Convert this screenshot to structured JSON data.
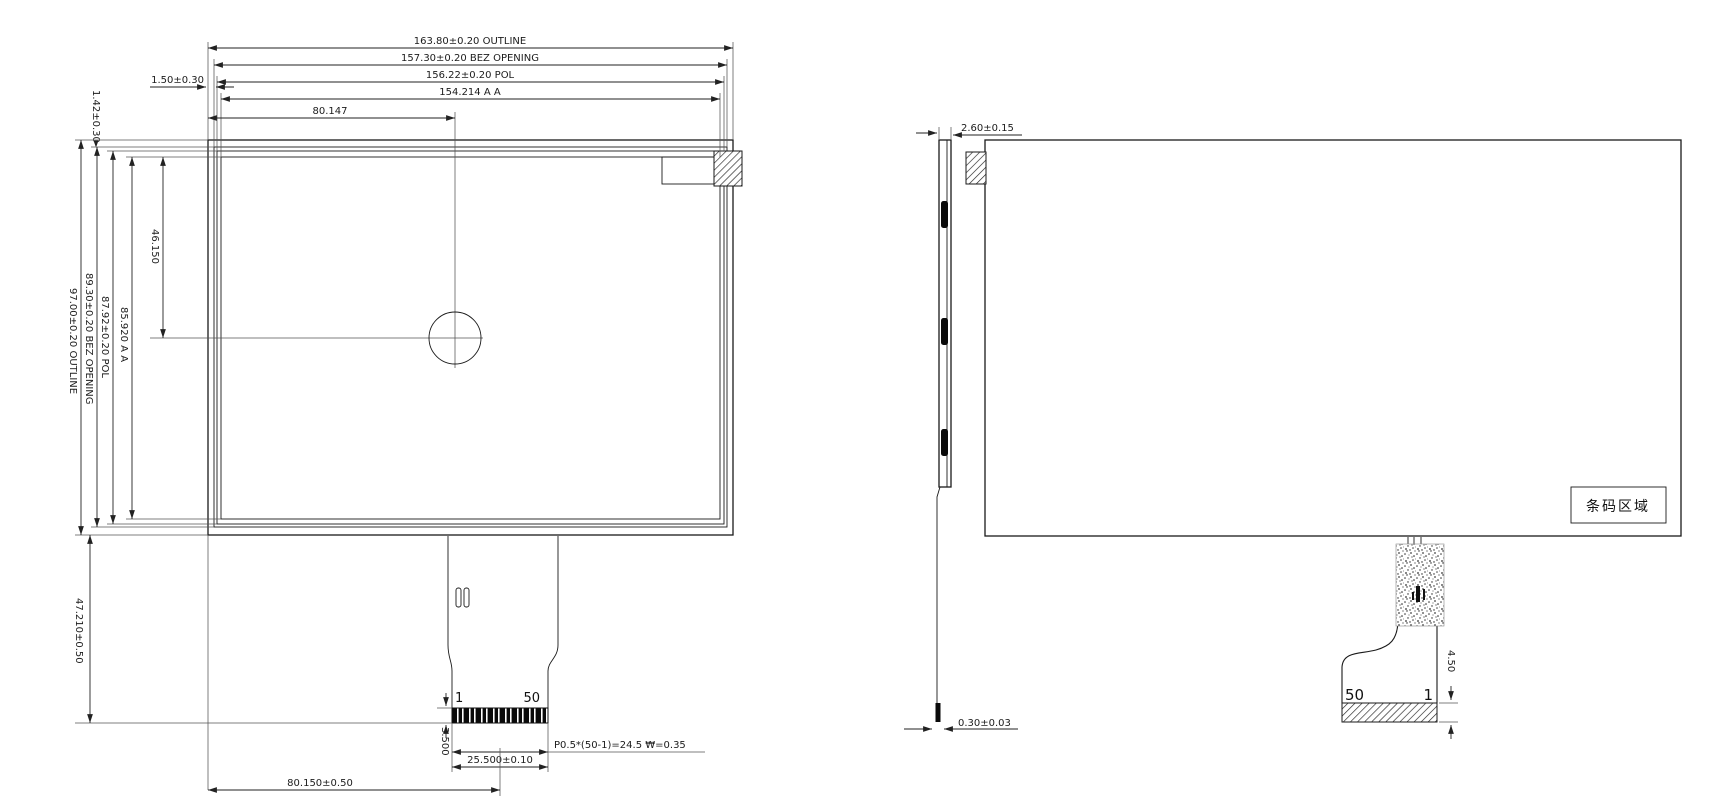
{
  "drawing_title": "LCD module outline drawing (front view, side view, rear view)",
  "front_view": {
    "dim_outline_width": "163.80±0.20 OUTLINE",
    "dim_bezel_width": "157.30±0.20 BEZ OPENING",
    "dim_pol_width": "156.22±0.20 POL",
    "dim_aa_width": "154.214 A A",
    "dim_center_x": "80.147",
    "dim_bezel_inset_left": "1.50±0.30",
    "dim_bezel_inset_top": "1.42±0.30",
    "dim_outline_height": "97.00±0.20 OUTLINE",
    "dim_bezel_height": "89.30±0.20 BEZ OPENING",
    "dim_pol_height": "87.92±0.20 POL",
    "dim_aa_height": "85.920 A A",
    "dim_center_y": "46.150",
    "dim_fpc_length": "47.210±0.50",
    "dim_contact_height": "3.500",
    "dim_connector_width": "25.500±0.10",
    "dim_pin_pitch": "P0.5*(50-1)=24.5 ₩=0.35",
    "dim_connector_center": "80.150±0.50",
    "pin_first": "1",
    "pin_last": "50"
  },
  "side_view": {
    "dim_thickness": "2.60±0.15",
    "dim_fpc_thickness": "0.30±0.03"
  },
  "rear_view": {
    "barcode_label": "条码区域",
    "pin_last": "50",
    "pin_first": "1",
    "dim_stiffener_height": "4.50"
  },
  "colors": {
    "line": "#1c1c1c",
    "background": "#ffffff"
  }
}
